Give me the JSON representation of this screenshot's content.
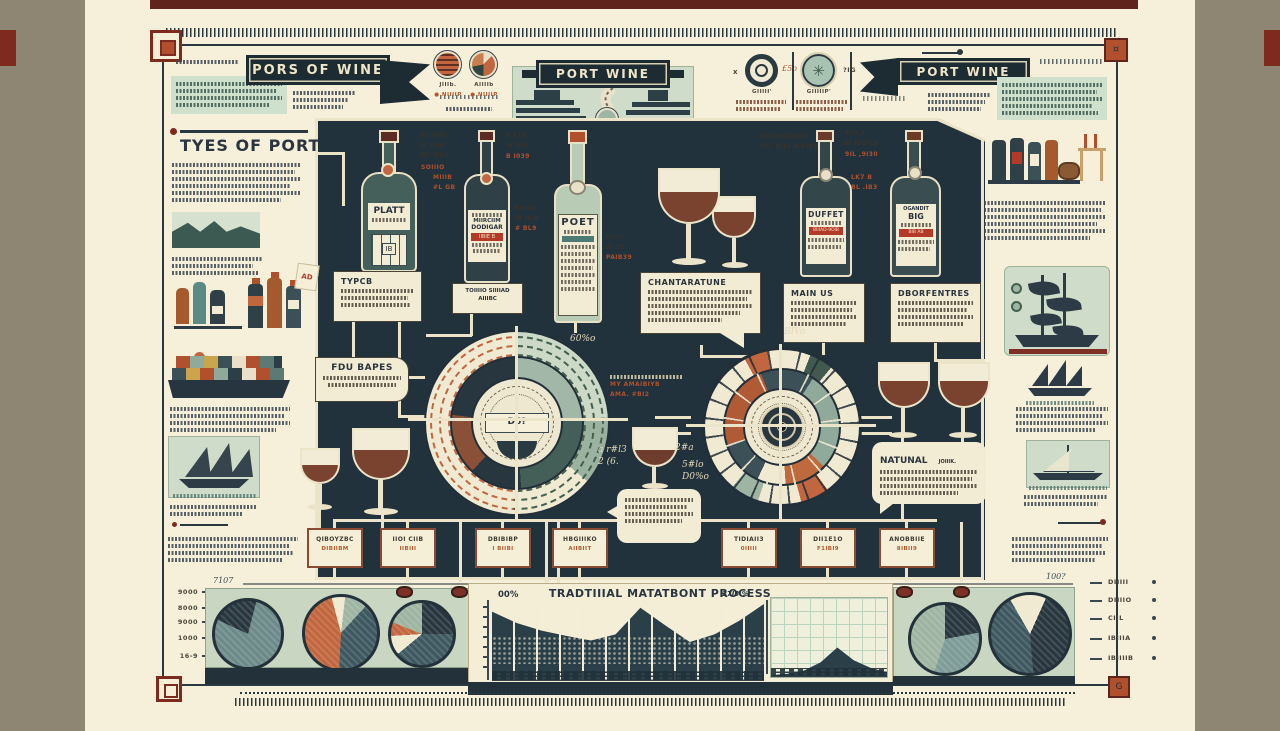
{
  "palette": {
    "navy": "#27363f",
    "teal": "#6d8a8b",
    "orange": "#c2663f",
    "sage": "#9fb5a3",
    "cream": "#f1ead2",
    "wave": "#7d9b98",
    "hatch": "#3e5862"
  },
  "header": {
    "left_banner": "PORS OF WINE",
    "center_banner": "PORT WINE",
    "right_banner": "PORT WINE",
    "center_caption": "'IIIIIIIP'",
    "circle1_label": "JIIIb.",
    "circle1_bullet": "● NIIIIP",
    "circle2_label": "AIIIIb",
    "circle2_bullet": "● NIIIIP",
    "compass1_caption": "GIIIII'",
    "compass2_caption": "GIIIIIP'",
    "mark_x": "x",
    "mark_pct": "£5o",
    "mark_ig": "?IG"
  },
  "left_column": {
    "heading": "TYES OF PORT",
    "tag": "AD"
  },
  "flowchart": {
    "bottle1": "PLATT",
    "bottle1_code": "IB",
    "bottle2_top": "MIIRCIIM",
    "bottle2": "DODIGAR",
    "bottle2_band": "IIBIE B",
    "bottle3": "POET",
    "bottle4": "DUFFET",
    "bottle4_band": "BIIIAD-9OIB",
    "bottle5_arc": "OGANDIT",
    "bottle5": "BIG",
    "bottle5_band": "BIB AB",
    "types": "TYPCB",
    "tawny1": "TOIIIIO SIIIIAD",
    "tawny2": "AIIIBC",
    "characteristics": "CHANTARATUNE",
    "main_us": "MAIN US",
    "properties": "DBORFENTRES",
    "four_grapes": "FDU BAPES",
    "natural": "NATUNAL",
    "natural_side": "JOIIIK.",
    "gauge": "D6?"
  },
  "annotations": [
    {
      "text": "KIIYAO\nK 5LM\nMI IP23"
    },
    {
      "text": "SOIIIO"
    },
    {
      "text": "MIIIB\n#L GB"
    },
    {
      "text": "K PLA\nW 9IB"
    },
    {
      "text": "B I039"
    },
    {
      "text": "BVIIA\nW NLB"
    },
    {
      "text": "# BL9"
    },
    {
      "text": "POIIT\nMI3Y"
    },
    {
      "text": "PAIB39"
    },
    {
      "text": "BIIA ELVAIBII\nMIL BIIA AIBIBP"
    },
    {
      "text": "BIII.A\nW HIBIIA"
    },
    {
      "text": "9IL ,9I30"
    },
    {
      "text": "LK7 B\nBL .IB3"
    },
    {
      "text": "MY AMAIBIYB\nAMA. #BI2"
    },
    {
      "text": "60%o"
    },
    {
      "text": "2#a"
    },
    {
      "text": "5#lo\nD0%o"
    },
    {
      "text": "a r#l3\n2 (6."
    },
    {
      "text": "BIVo"
    }
  ],
  "label_boxes": [
    {
      "l1": "QIBOYZBC",
      "l2": "DIBIIBM"
    },
    {
      "l1": "IIOI CIIB",
      "l2": "IIBIII"
    },
    {
      "l1": "DBIBIBP",
      "l2": "I BIIBI"
    },
    {
      "l1": "HBGIIIKO",
      "l2": "AIIBIIT"
    },
    {
      "l1": "TIDIAII3",
      "l2": "0IIIII"
    },
    {
      "l1": "DII1E1O",
      "l2": "F1IBI9"
    },
    {
      "l1": "ANOBBIIE",
      "l2": "8IBII9"
    }
  ],
  "bottom": {
    "title": "TRADTIIIAL MATATBONT PROCESS",
    "pct_left": "00%",
    "pct_right": "27I3 %",
    "script_left": "7107",
    "script_right": "100?",
    "axis_left": [
      "9000",
      "8000",
      "9000",
      "1000",
      "16-9"
    ],
    "legend_right": [
      "DIIIII",
      "DIIIIO",
      "CIIL",
      "IBIIIA",
      "IBIIIIB"
    ]
  },
  "chart_data": {
    "pie1": {
      "type": "pie",
      "rotate": -65,
      "slices": [
        {
          "color": "navy",
          "pct": 22
        },
        {
          "color": "teal",
          "pct": 78
        }
      ]
    },
    "pie2": {
      "type": "pie",
      "rotate": -15,
      "slices": [
        {
          "color": "cream",
          "pct": 6
        },
        {
          "color": "sage",
          "pct": 10
        },
        {
          "color": "hatch",
          "pct": 39
        },
        {
          "color": "orange",
          "pct": 45
        }
      ]
    },
    "pie3": {
      "type": "pie",
      "rotate": 0,
      "slices": [
        {
          "color": "navy",
          "pct": 25
        },
        {
          "color": "hatch",
          "pct": 39
        },
        {
          "color": "cream",
          "pct": 10
        },
        {
          "color": "orange",
          "pct": 7
        },
        {
          "color": "sage",
          "pct": 19
        }
      ]
    },
    "pie4": {
      "type": "pie",
      "rotate": 0,
      "slices": [
        {
          "color": "navy",
          "pct": 22
        },
        {
          "color": "wave",
          "pct": 33
        },
        {
          "color": "sage",
          "pct": 45
        }
      ]
    },
    "pie5": {
      "type": "pie",
      "rotate": -30,
      "slices": [
        {
          "color": "cream",
          "pct": 15
        },
        {
          "color": "navy",
          "pct": 42
        },
        {
          "color": "hatch",
          "pct": 43
        }
      ]
    },
    "process_area": {
      "type": "area",
      "heights": [
        0.9,
        0.75,
        0.65,
        0.58,
        0.52,
        0.6,
        0.95,
        0.72,
        0.5,
        0.6,
        0.78,
        1.0
      ]
    },
    "grid_area": {
      "type": "area",
      "heights": [
        0.02,
        0.05,
        0.12,
        0.3,
        0.62,
        0.34,
        0.18,
        0.08
      ]
    }
  }
}
